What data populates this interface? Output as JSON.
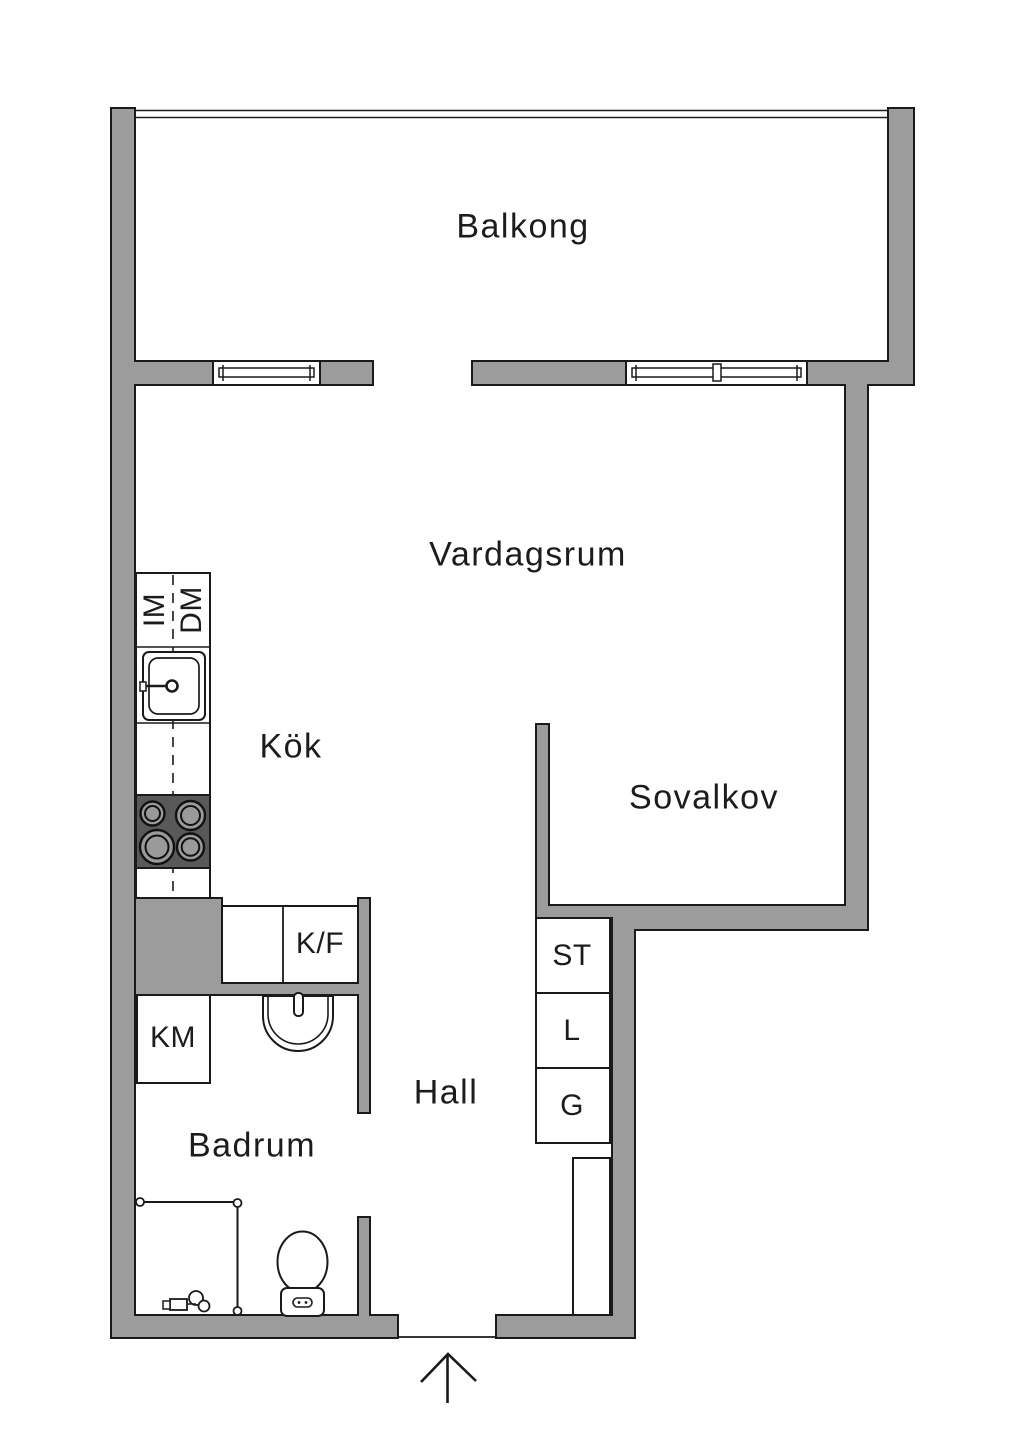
{
  "rooms": {
    "balkong": {
      "label": "Balkong"
    },
    "vardagsrum": {
      "label": "Vardagsrum"
    },
    "kok": {
      "label": "Kök"
    },
    "sovalkov": {
      "label": "Sovalkov"
    },
    "hall": {
      "label": "Hall"
    },
    "badrum": {
      "label": "Badrum"
    }
  },
  "closets": {
    "st": {
      "label": "ST"
    },
    "l": {
      "label": "L"
    },
    "g": {
      "label": "G"
    }
  },
  "appliances": {
    "im": {
      "label": "IM"
    },
    "dm": {
      "label": "DM"
    },
    "kf": {
      "label": "K/F"
    },
    "km": {
      "label": "KM"
    }
  },
  "colors": {
    "wall": "#9c9c9c",
    "stove": "#595959",
    "burner": "#9a9a9a",
    "outline": "#1a1a1a",
    "background": "#ffffff"
  }
}
